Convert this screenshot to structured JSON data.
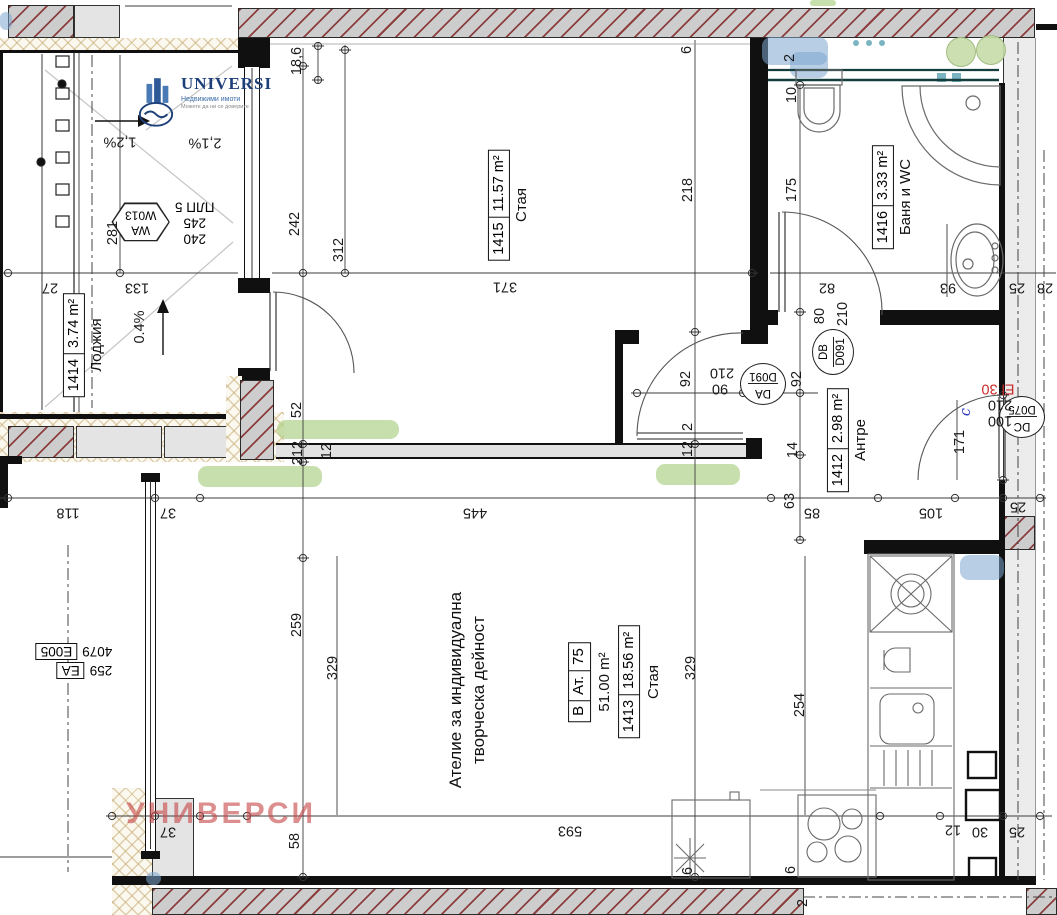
{
  "brand": {
    "name": "UNIVERSI",
    "subtitle": "Недвижими имоти",
    "tagline": "Можете да ни се доверите"
  },
  "watermark": "УНИВЕРСИ",
  "unit": {
    "letter": "В",
    "type_label": "Ат.",
    "number": "75",
    "total_area": "51.00 m²",
    "room_id": "1413",
    "room_area": "18.56 m²",
    "room_name": "Стая"
  },
  "atelier": {
    "line1": "Ателие за индивидуална",
    "line2": "творческа дейност"
  },
  "rooms": [
    {
      "id": "1415",
      "area": "11.57 m²",
      "name": "Стая",
      "x": 509,
      "y": 205
    },
    {
      "id": "1414",
      "area": "3.74 m²",
      "name": "Лоджия",
      "x": 84,
      "y": 345
    },
    {
      "id": "1416",
      "area": "3.33 m²",
      "name": "Баня и WC",
      "x": 893,
      "y": 197
    },
    {
      "id": "1412",
      "area": "2.98 m²",
      "name": "Антре",
      "x": 848,
      "y": 440
    }
  ],
  "doors": {
    "da": {
      "code": "DA",
      "type": "D091"
    },
    "db": {
      "code": "DB",
      "type": "D091"
    },
    "dc": {
      "code": "DC",
      "type": "D075"
    }
  },
  "window_tag": {
    "code": "WA",
    "type": "W013",
    "w": "240",
    "h": "245",
    "note": "ПЛП 5"
  },
  "axis_tag": {
    "d1": "259",
    "c1": "EA",
    "d2": "4079",
    "c2": "E005"
  },
  "dims": [
    {
      "t": "27",
      "x": 50,
      "y": 287,
      "r": 180
    },
    {
      "t": "281",
      "x": 113,
      "y": 233,
      "r": -90
    },
    {
      "t": "133",
      "x": 137,
      "y": 287,
      "r": 180
    },
    {
      "t": "1,2%",
      "x": 120,
      "y": 141,
      "r": 180
    },
    {
      "t": "2,1%",
      "x": 205,
      "y": 142,
      "r": 180
    },
    {
      "t": "0.4%",
      "x": 140,
      "y": 327,
      "r": -90
    },
    {
      "t": "242",
      "x": 295,
      "y": 224,
      "r": -90
    },
    {
      "t": "312",
      "x": 339,
      "y": 250,
      "r": -90
    },
    {
      "t": "371",
      "x": 505,
      "y": 286,
      "r": 180
    },
    {
      "t": "218",
      "x": 688,
      "y": 190,
      "r": -90
    },
    {
      "t": "18,6",
      "x": 297,
      "y": 61,
      "r": -90
    },
    {
      "t": "6",
      "x": 687,
      "y": 50,
      "r": -90
    },
    {
      "t": "2",
      "x": 790,
      "y": 58,
      "r": -90
    },
    {
      "t": "10",
      "x": 792,
      "y": 95,
      "r": -90
    },
    {
      "t": "175",
      "x": 792,
      "y": 190,
      "r": -90
    },
    {
      "t": "82",
      "x": 827,
      "y": 287,
      "r": 180
    },
    {
      "t": "93",
      "x": 948,
      "y": 287,
      "r": 180
    },
    {
      "t": "25",
      "x": 1017,
      "y": 287,
      "r": 180
    },
    {
      "t": "28",
      "x": 1045,
      "y": 287,
      "r": 180
    },
    {
      "t": "52",
      "x": 297,
      "y": 410,
      "r": -90
    },
    {
      "t": "212",
      "x": 298,
      "y": 453,
      "r": -90
    },
    {
      "t": "12",
      "x": 327,
      "y": 451,
      "r": -90
    },
    {
      "t": "2",
      "x": 688,
      "y": 427,
      "r": -90
    },
    {
      "t": "12",
      "x": 688,
      "y": 449,
      "r": -90
    },
    {
      "t": "92",
      "x": 686,
      "y": 379,
      "r": -90
    },
    {
      "t": "210",
      "x": 722,
      "y": 372,
      "r": 180
    },
    {
      "t": "90",
      "x": 720,
      "y": 388,
      "r": 180
    },
    {
      "t": "92",
      "x": 797,
      "y": 379,
      "r": -90
    },
    {
      "t": "80",
      "x": 820,
      "y": 316,
      "r": -90
    },
    {
      "t": "210",
      "x": 843,
      "y": 314,
      "r": -90
    },
    {
      "t": "14",
      "x": 793,
      "y": 450,
      "r": -90
    },
    {
      "t": "63",
      "x": 790,
      "y": 501,
      "r": -90
    },
    {
      "t": "85",
      "x": 812,
      "y": 512,
      "r": 180
    },
    {
      "t": "105",
      "x": 931,
      "y": 512,
      "r": 180
    },
    {
      "t": "25",
      "x": 1018,
      "y": 506,
      "r": 180
    },
    {
      "t": "171",
      "x": 960,
      "y": 442,
      "r": -90
    },
    {
      "t": "c",
      "x": 966,
      "y": 412,
      "r": -90,
      "cls": "blue"
    },
    {
      "t": "210",
      "x": 1000,
      "y": 404,
      "r": 180
    },
    {
      "t": "100",
      "x": 1000,
      "y": 420,
      "r": 180
    },
    {
      "t": "El 30",
      "x": 998,
      "y": 388,
      "r": 180,
      "cls": "red"
    },
    {
      "t": "118",
      "x": 68,
      "y": 512,
      "r": 180
    },
    {
      "t": "37",
      "x": 168,
      "y": 512,
      "r": 180
    },
    {
      "t": "445",
      "x": 475,
      "y": 512,
      "r": 180
    },
    {
      "t": "259",
      "x": 297,
      "y": 625,
      "r": -90
    },
    {
      "t": "329",
      "x": 333,
      "y": 668,
      "r": -90
    },
    {
      "t": "329",
      "x": 691,
      "y": 668,
      "r": -90
    },
    {
      "t": "254",
      "x": 800,
      "y": 705,
      "r": -90
    },
    {
      "t": "37",
      "x": 168,
      "y": 831,
      "r": 180
    },
    {
      "t": "58",
      "x": 295,
      "y": 841,
      "r": -90
    },
    {
      "t": "593",
      "x": 570,
      "y": 830,
      "r": 180
    },
    {
      "t": "6",
      "x": 688,
      "y": 871,
      "r": -90
    },
    {
      "t": "6",
      "x": 791,
      "y": 870,
      "r": -90
    },
    {
      "t": "12",
      "x": 953,
      "y": 829,
      "r": 180
    },
    {
      "t": "30",
      "x": 980,
      "y": 831,
      "r": 180
    },
    {
      "t": "25",
      "x": 1017,
      "y": 831,
      "r": 180
    },
    {
      "t": "2",
      "x": 803,
      "y": 903,
      "r": -90
    }
  ]
}
